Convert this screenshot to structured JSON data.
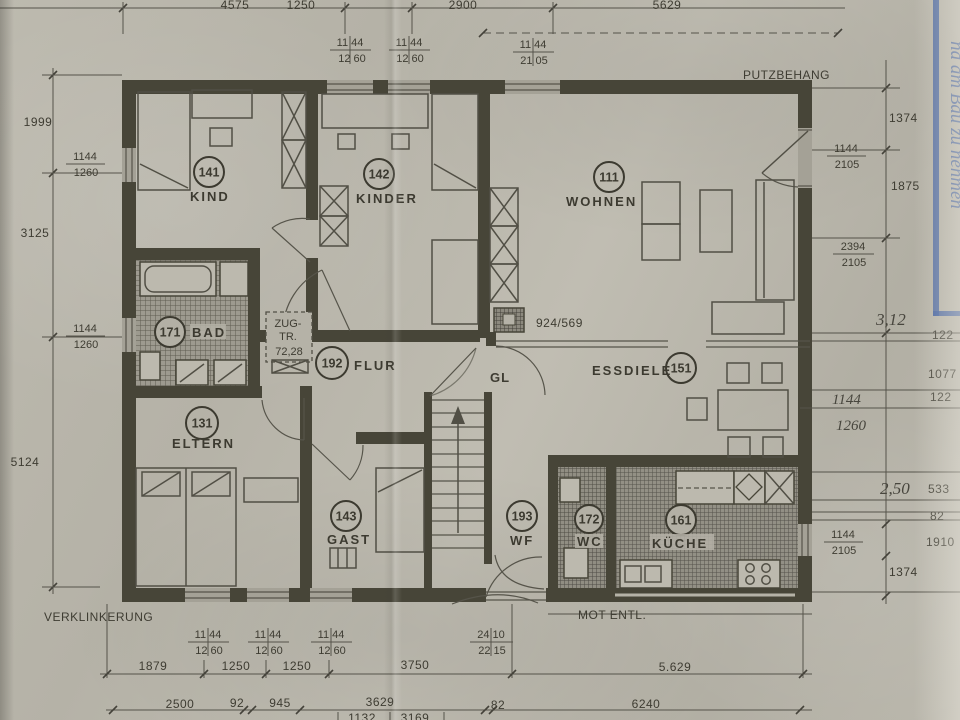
{
  "colors": {
    "paper": "#b8b5aa",
    "ink": "#403e36",
    "blue_pen": "#3f5e9e"
  },
  "rooms": [
    {
      "num": "141",
      "name": "KIND"
    },
    {
      "num": "142",
      "name": "KINDER"
    },
    {
      "num": "111",
      "name": "WOHNEN"
    },
    {
      "num": "171",
      "name": "BAD"
    },
    {
      "num": "192",
      "name": "FLUR"
    },
    {
      "num": "151",
      "name": "ESSDIELE"
    },
    {
      "num": "131",
      "name": "ELTERN"
    },
    {
      "num": "143",
      "name": "GAST"
    },
    {
      "num": "193",
      "name": "WF"
    },
    {
      "num": "172",
      "name": "WC"
    },
    {
      "num": "161",
      "name": "KÜCHE"
    }
  ],
  "labels": {
    "putzbehang": "PUTZBEHANG",
    "verklinkerung": "VERKLINKERUNG",
    "mot_entl": "MOT ENTL.",
    "gl": "GL",
    "ref": "924/569",
    "zug1": "ZUG-",
    "zug2": "TR.",
    "zug3": "72,28"
  },
  "handwritten": {
    "blue_note": "nd am Bau zu nehmen",
    "r1": "3,12",
    "r2_top": "1144",
    "r2_bot": "1260",
    "r3": "2,50"
  },
  "dims": {
    "top": [
      "4575",
      "1250",
      "2900",
      "5629"
    ],
    "fr_top": [
      [
        "11 44",
        "12 60"
      ],
      [
        "11 44",
        "12 60"
      ],
      [
        "11 44",
        "21 05"
      ]
    ],
    "left": [
      "1999",
      "3125",
      "5124"
    ],
    "fr_left": [
      [
        "1144",
        "1260"
      ],
      [
        "1144",
        "1260"
      ]
    ],
    "right_in": [
      "1374",
      "1875",
      "1374"
    ],
    "fr_right": [
      [
        "1144",
        "2105"
      ],
      [
        "2394",
        "2105"
      ],
      [
        "1144",
        "2105"
      ]
    ],
    "right_out": [
      "122",
      "1077",
      "122",
      "533",
      "82",
      "1910"
    ],
    "fr_bottom": [
      [
        "11 44",
        "12 60"
      ],
      [
        "11 44",
        "12 60"
      ],
      [
        "11 44",
        "12 60"
      ],
      [
        "24 10",
        "22 15"
      ]
    ],
    "bottom1": [
      "1879",
      "1250",
      "1250",
      "3750",
      "5.629"
    ],
    "bottom2": [
      "2500",
      "92",
      "945",
      "3629",
      "82",
      "6240"
    ],
    "bottom3": [
      "1132",
      "3169"
    ]
  }
}
